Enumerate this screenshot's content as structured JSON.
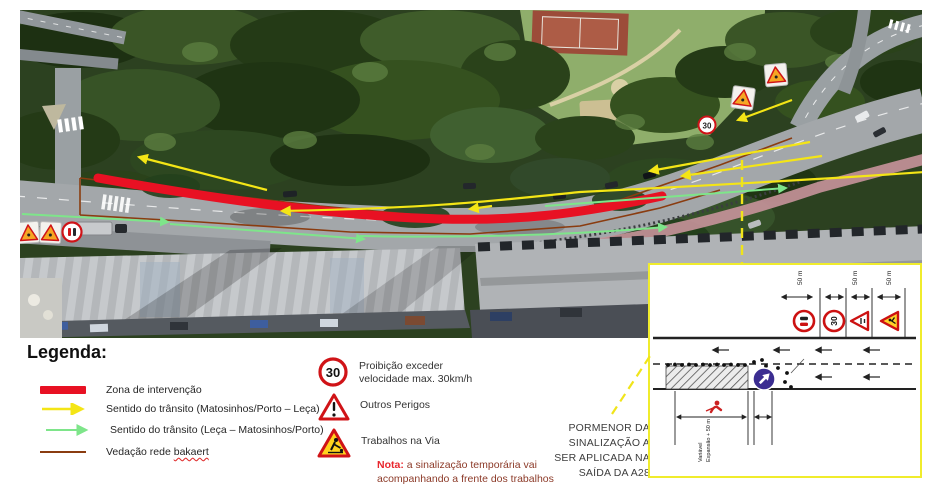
{
  "legend": {
    "title": "Legenda:",
    "items": [
      {
        "label": "Zona de intervenção",
        "swatch": "red-band",
        "color": "#e81123"
      },
      {
        "label": "Sentido do trânsito (Matosinhos/Porto – Leça)",
        "swatch": "yellow-arrow",
        "color": "#f4e516"
      },
      {
        "label": "Sentido do trânsito (Leça – Matosinhos/Porto)",
        "swatch": "green-arrow",
        "color": "#7ee58a"
      },
      {
        "label_prefix": "Vedação rede ",
        "label_suffix": "bakaert",
        "swatch": "brown-line",
        "color": "#8a3c10"
      }
    ]
  },
  "signs": {
    "speed": {
      "value": "30",
      "line1": "Proibição exceder",
      "line2": "velocidade max. 30km/h"
    },
    "danger": {
      "label": "Outros Perigos"
    },
    "works": {
      "label": "Trabalhos na Via"
    }
  },
  "note": {
    "prefix": "Nota:",
    "text": " a sinalização temporária vai acompanhando a frente dos trabalhos"
  },
  "callout": {
    "lines": [
      "PORMENOR DA",
      "SINALIZAÇÃO A",
      "SER APLICADA NA",
      "SAÍDA DA A28"
    ]
  },
  "inset": {
    "distance_labels": [
      "50 m",
      "50 m",
      "50 m"
    ],
    "speed_value": "30",
    "zone_labels": [
      "Variável",
      "Expansão + 50 m"
    ]
  }
}
